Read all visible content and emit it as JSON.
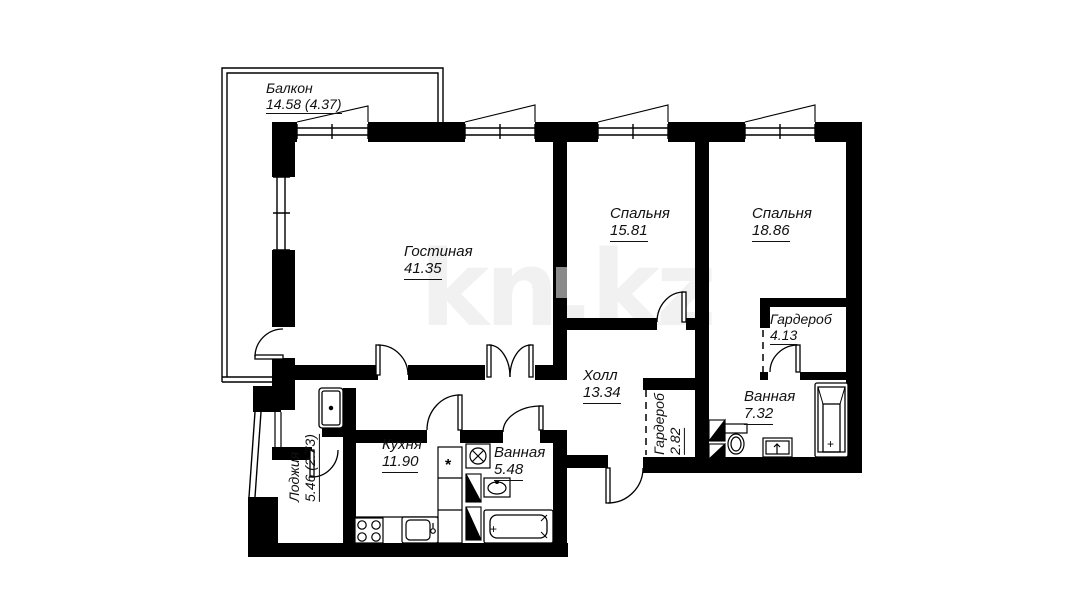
{
  "watermark": {
    "text": "kn.kz"
  },
  "rooms": [
    {
      "id": "balcony",
      "name": "Балкон",
      "area": "14.58 (4.37)"
    },
    {
      "id": "living-room",
      "name": "Гостиная",
      "area": "41.35"
    },
    {
      "id": "bedroom-1",
      "name": "Спальня",
      "area": "15.81"
    },
    {
      "id": "bedroom-2",
      "name": "Спальня",
      "area": "18.86"
    },
    {
      "id": "wardrobe-1",
      "name": "Гардероб",
      "area": "4.13"
    },
    {
      "id": "hall",
      "name": "Холл",
      "area": "13.34"
    },
    {
      "id": "wardrobe-2",
      "name": "Гардероб",
      "area": "2.82"
    },
    {
      "id": "bathroom-1",
      "name": "Ванная",
      "area": "7.32"
    },
    {
      "id": "kitchen",
      "name": "Кухня",
      "area": "11.90"
    },
    {
      "id": "bathroom-2",
      "name": "Ванная",
      "area": "5.48"
    },
    {
      "id": "loggia",
      "name": "Лоджия",
      "area": "5.46 (2.73)"
    }
  ],
  "symbols": {
    "star": "*",
    "plus": "+"
  },
  "colors": {
    "walls": "#000000",
    "shaft": "#8a8a8a",
    "watermark": "#f1f1f1",
    "label_text": "#111111"
  }
}
